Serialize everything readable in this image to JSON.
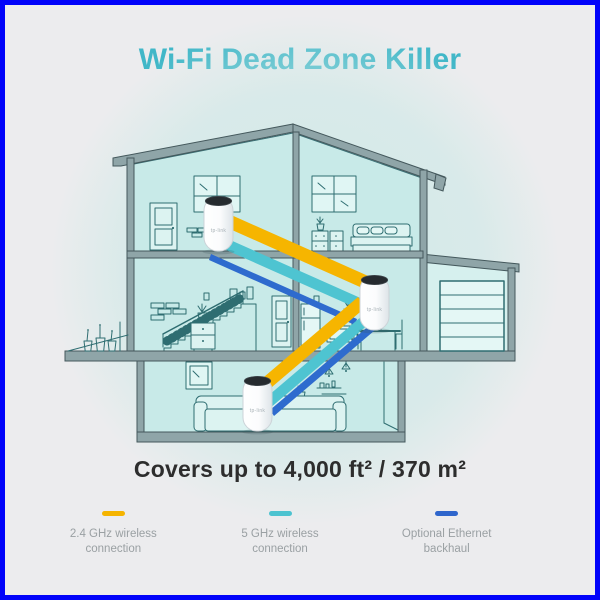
{
  "frame": {
    "border_color": "#0103fa",
    "background": "#ececee"
  },
  "header": {
    "title": "Wi-Fi Dead Zone Killer",
    "title_color": "#41b7c8"
  },
  "coverage": {
    "text": "Covers up to 4,000 ft² / 370 m²"
  },
  "legend": {
    "items": [
      {
        "line1": "2.4 GHz wireless",
        "line2": "connection",
        "color": "#f5b400"
      },
      {
        "line1": "5 GHz wireless",
        "line2": "connection",
        "color": "#4cc3d0"
      },
      {
        "line1": "Optional Ethernet",
        "line2": "backhaul",
        "color": "#2f66cc"
      }
    ]
  },
  "diagram": {
    "units": [
      {
        "logo": "tp-link"
      },
      {
        "logo": "tp-link"
      },
      {
        "logo": "tp-link"
      }
    ],
    "band_colors": {
      "wireless_2_4ghz": "#f6b500",
      "wireless_5ghz": "#4ec4d1",
      "ethernet": "#2e6bce"
    }
  }
}
